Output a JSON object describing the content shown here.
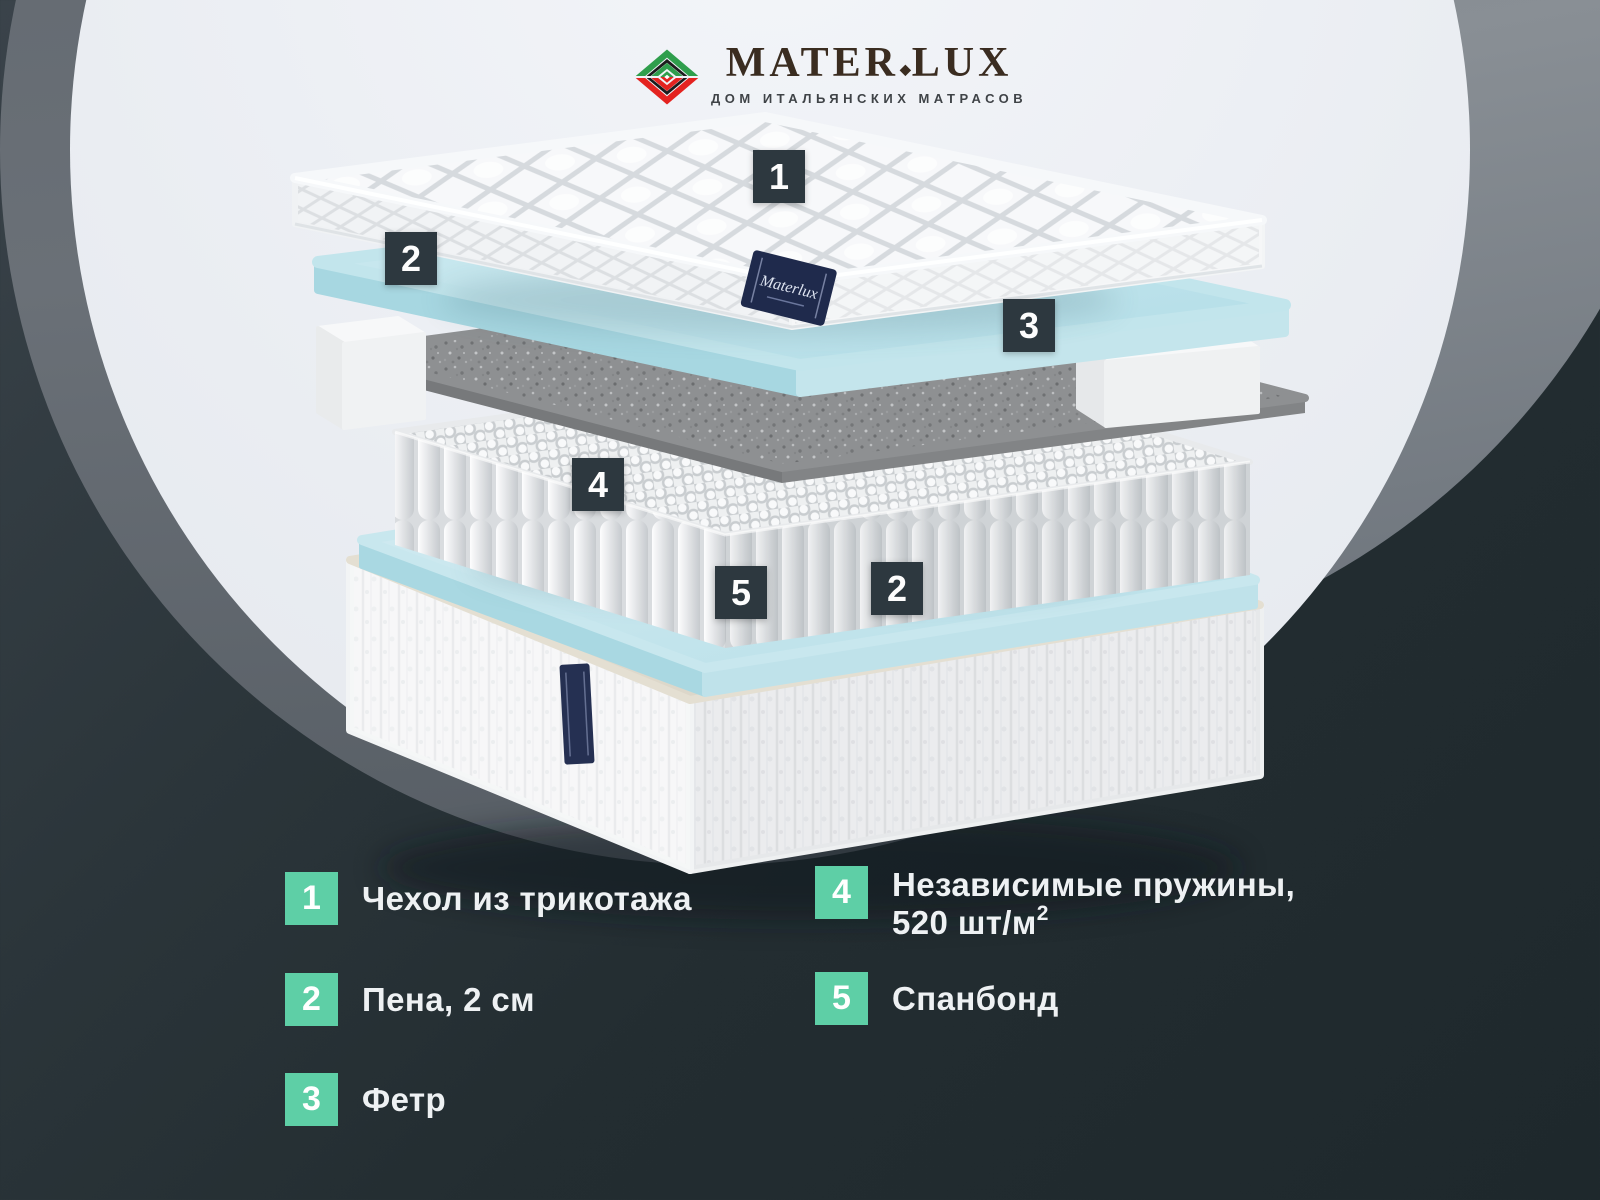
{
  "brand": {
    "logo_icon": "nested-diamond-mark",
    "name_part1": "MATER",
    "name_separator": "◆",
    "name_part2": "LUX",
    "subtitle": "ДОМ ИТАЛЬЯНСКИХ МАТРАСОВ"
  },
  "diagram": {
    "hang_tag_text": "Materlux",
    "callouts": [
      {
        "number": "1"
      },
      {
        "number": "2"
      },
      {
        "number": "3"
      },
      {
        "number": "4"
      },
      {
        "number": "5"
      },
      {
        "number": "2"
      }
    ]
  },
  "legend": {
    "items": [
      {
        "number": "1",
        "label": "Чехол из трикотажа"
      },
      {
        "number": "2",
        "label": "Пена, 2 см"
      },
      {
        "number": "3",
        "label": "Фетр"
      },
      {
        "number": "4",
        "label": "Независимые пружины,",
        "label_line2": "520 шт/м",
        "label_sup": "2"
      },
      {
        "number": "5",
        "label": "Спанбонд"
      }
    ]
  },
  "colors": {
    "accent": "#5ecfa6",
    "callout_bg": "#2d383f",
    "logo_green": "#2f9e4c",
    "logo_red": "#e42320",
    "foam_blue": "#c4e6ec",
    "felt_gray": "#8e9092",
    "base_beige": "#e0dacb"
  }
}
